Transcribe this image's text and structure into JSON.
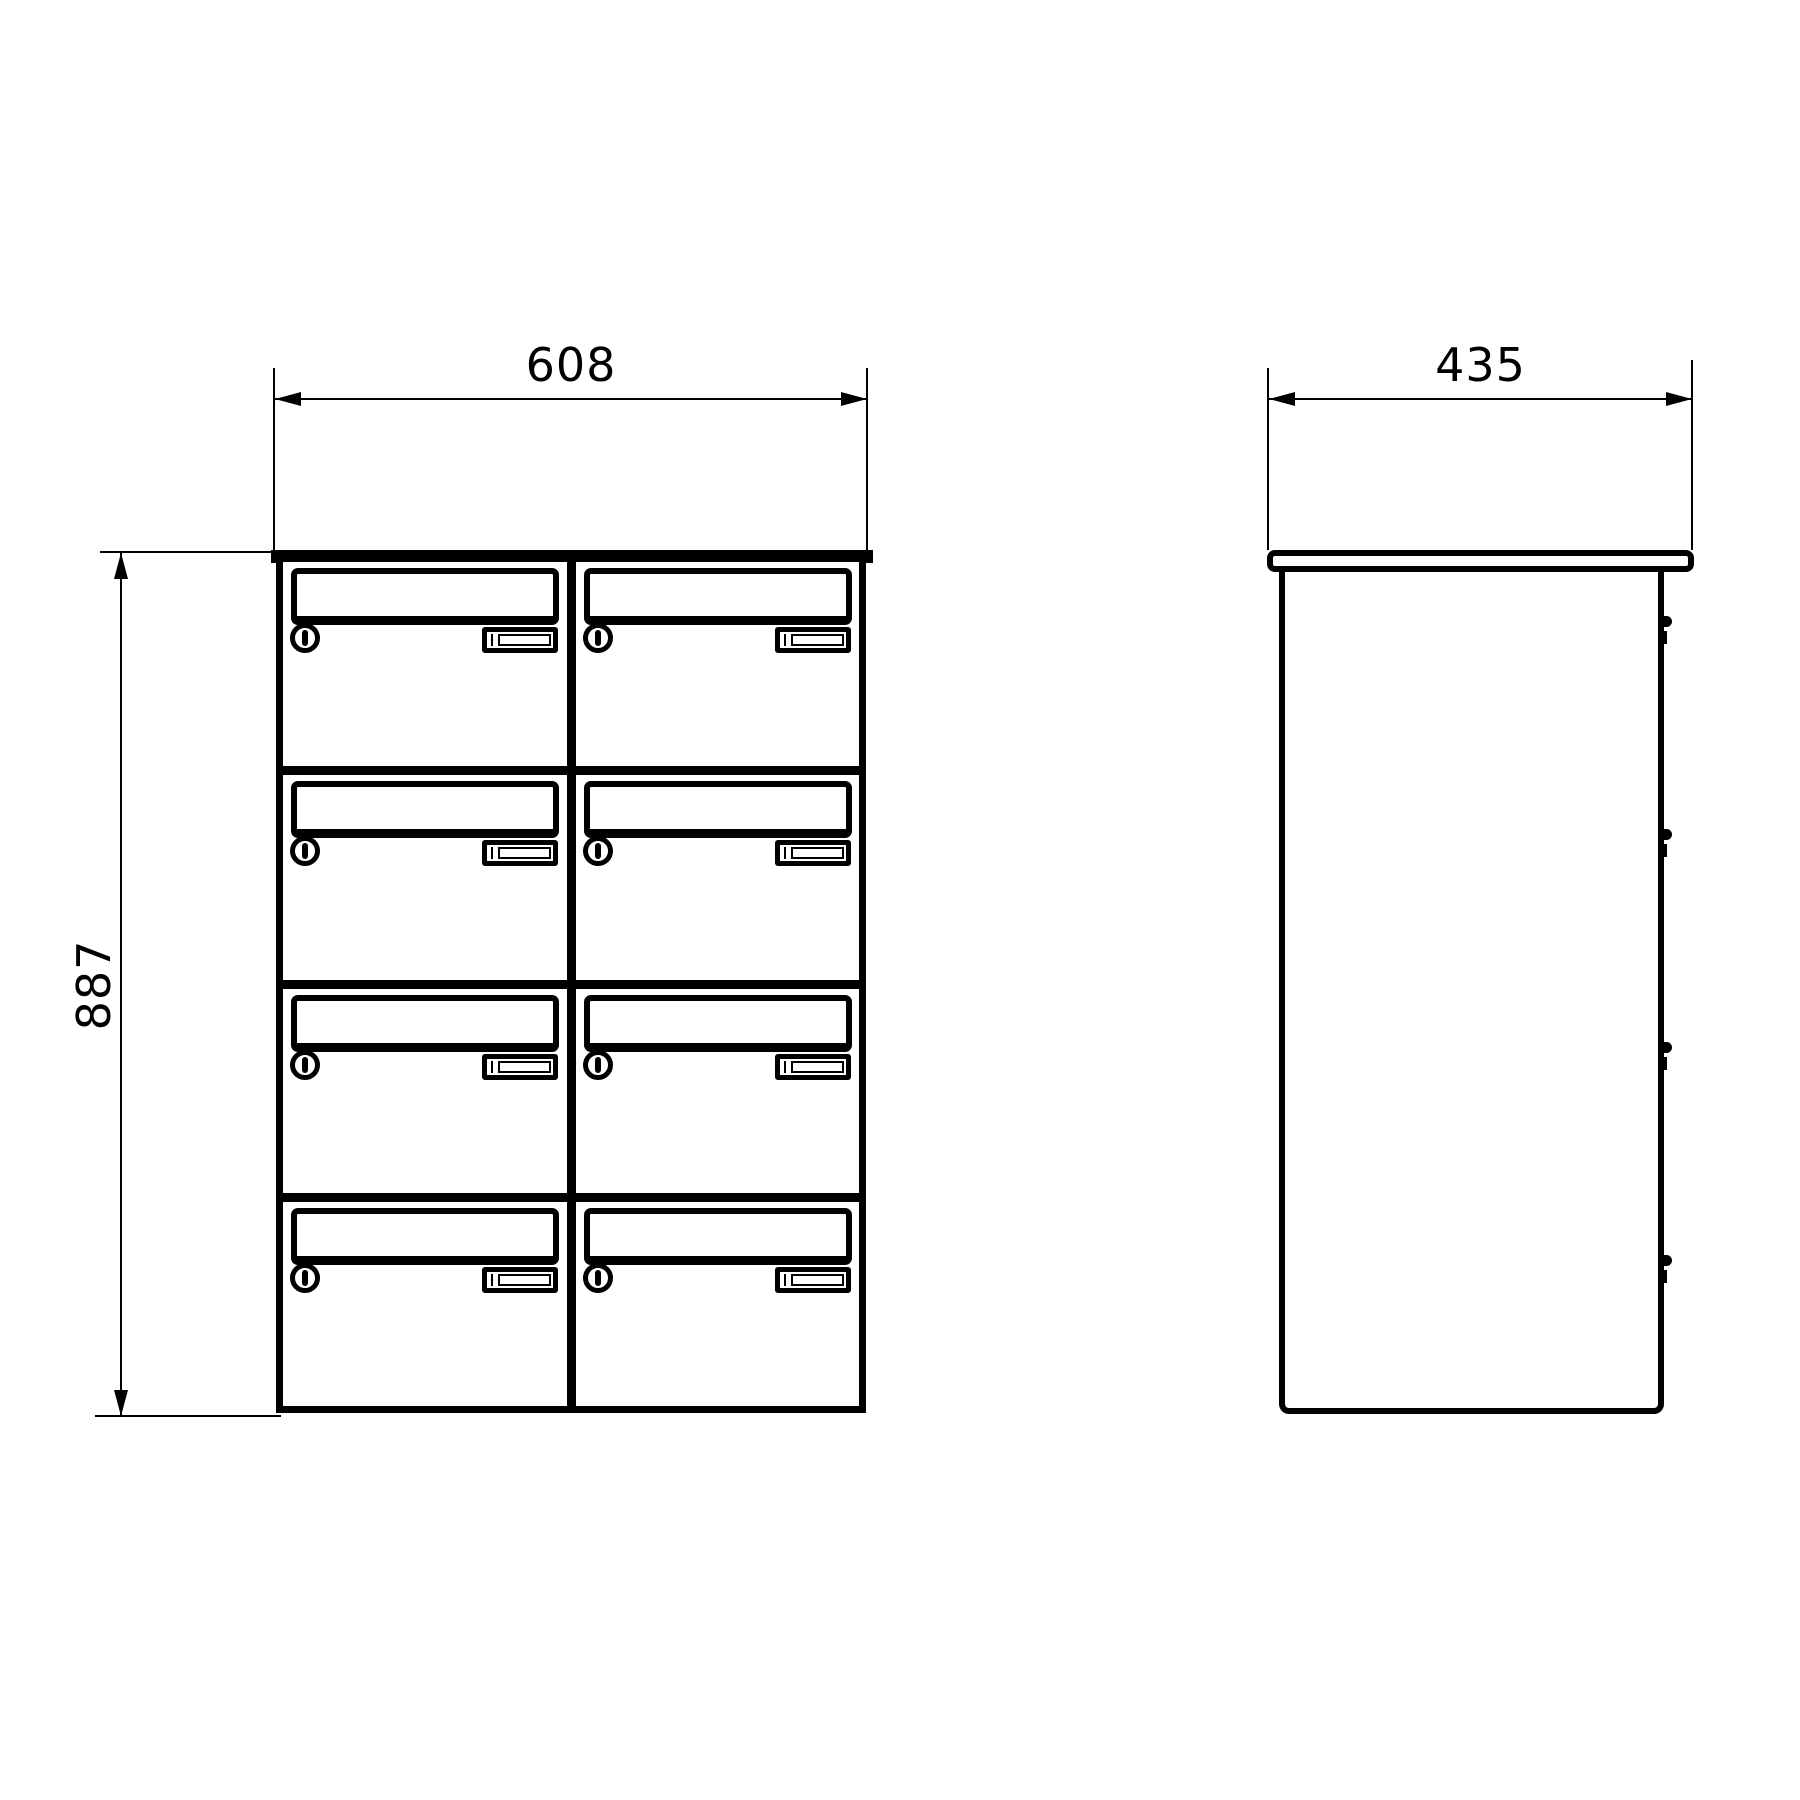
{
  "drawing": {
    "type": "technical dimension drawing",
    "object": "bank of 8 lockable mailboxes",
    "line_color": "#000000",
    "background_color": "#ffffff"
  },
  "front_view": {
    "rows": 4,
    "columns": 2,
    "cell_count": 8,
    "width_dimension": "608",
    "height_dimension": "887"
  },
  "side_view": {
    "hinge_count": 4,
    "depth_dimension": "435"
  }
}
